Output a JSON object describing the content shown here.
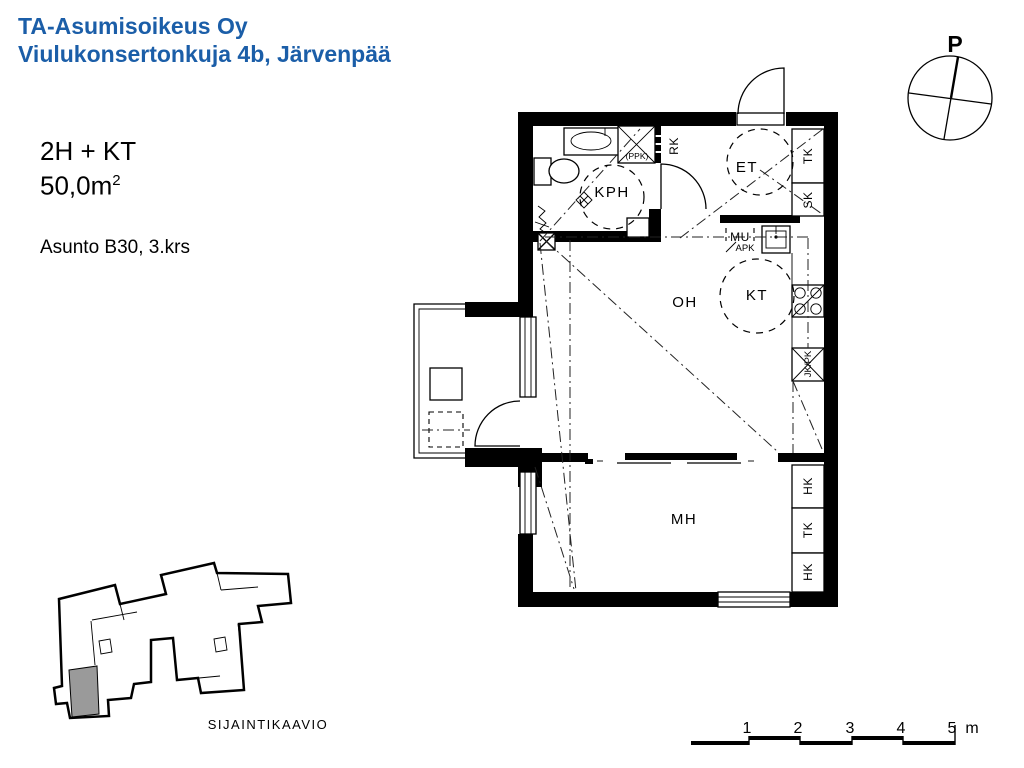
{
  "header": {
    "company": "TA-Asumisoikeus Oy",
    "address": "Viulukonsertonkuja 4b, Järvenpää"
  },
  "info": {
    "layout": "2H + KT",
    "area_value": "50,0m",
    "area_exponent": "2",
    "apartment": "Asunto B30, 3.krs"
  },
  "compass": {
    "north_label": "P"
  },
  "plan": {
    "rooms": {
      "bathroom": "KPH",
      "entry": "ET",
      "living": "OH",
      "kitchen": "KT",
      "bedroom": "MH"
    },
    "labels": {
      "rk": "RK",
      "tk_hall": "TK",
      "sk": "SK",
      "ppk": "(PPK)",
      "mu": "MU",
      "apk": "APK",
      "jk_pk": "JK/PK",
      "hk_upper": "HK",
      "tk_bedroom": "TK",
      "hk_lower": "HK"
    }
  },
  "location_diagram": {
    "caption": "SIJAINTIKAAVIO"
  },
  "scale_bar": {
    "ticks": [
      "1",
      "2",
      "3",
      "4",
      "5"
    ],
    "unit": "m"
  },
  "colors": {
    "title_blue": "#1b5ea8",
    "highlight_gray": "#9a9a9a"
  }
}
